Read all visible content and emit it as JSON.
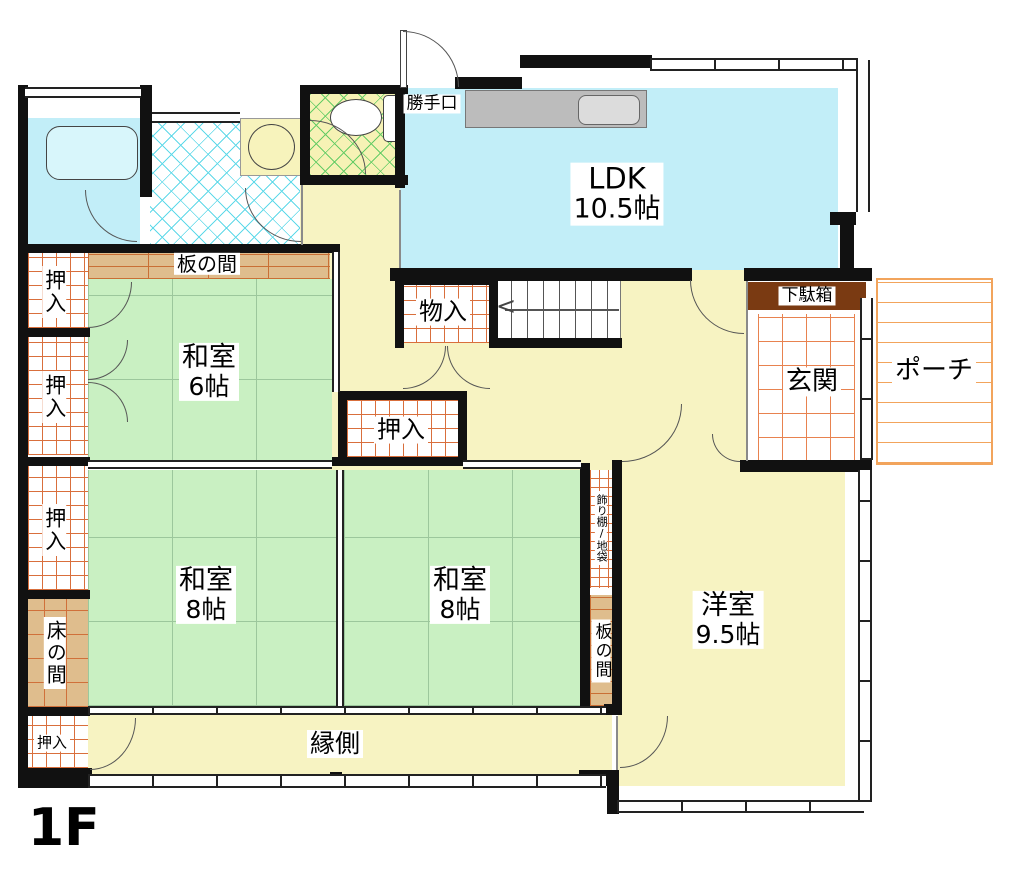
{
  "floor_label": "1F",
  "rooms": {
    "ldk": {
      "name": "LDK",
      "size": "10.5帖"
    },
    "washitsu_6": {
      "name": "和室",
      "size": "6帖"
    },
    "washitsu_8_left": {
      "name": "和室",
      "size": "8帖"
    },
    "washitsu_8_right": {
      "name": "和室",
      "size": "8帖"
    },
    "youshitsu": {
      "name": "洋室",
      "size": "9.5帖"
    }
  },
  "labels": {
    "genkan": "玄関",
    "porch": "ポーチ",
    "getabako": "下駄箱",
    "katteguchi": "勝手口",
    "monoire": "物入",
    "itanoma": "板の間",
    "tokonoma": "床の間",
    "engawa": "縁側",
    "kazaridana_jibukuro": "飾り棚/地袋",
    "oshiire": "押入"
  },
  "colors": {
    "tatami": "#c9f0c2",
    "water": "#c2eef8",
    "floor": "#f7f3c2",
    "wood": "#dfbd8d",
    "hatch": "#d96f3c",
    "porch": "#f2a45c",
    "getabako": "#7a3a12",
    "counter": "#bcbcbc",
    "wall": "#111111"
  }
}
